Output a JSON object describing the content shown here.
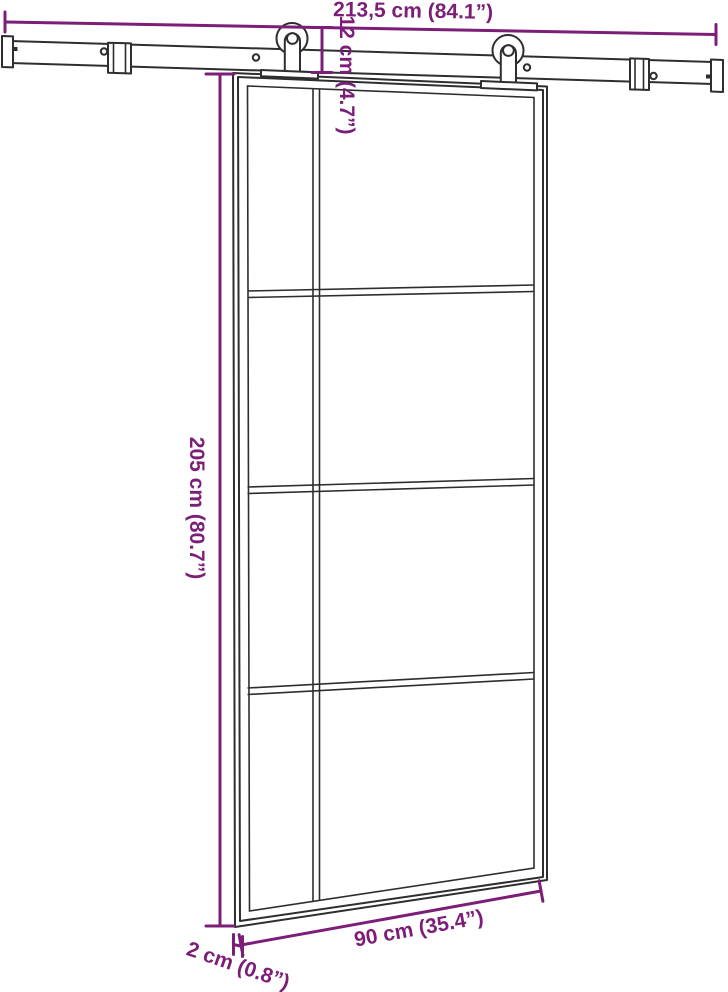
{
  "colors": {
    "dimension_annotation": "#7c1e78",
    "line_art": "#2e2e2e",
    "background": "#ffffff"
  },
  "dimensions": {
    "rail_width": {
      "cm": "213,5",
      "inches": "84.1",
      "label": "213,5 cm (84.1”)"
    },
    "hanger_height": {
      "cm": "12",
      "inches": "4.7",
      "label": "12 cm (4.7”)"
    },
    "door_height": {
      "cm": "205",
      "inches": "80.7",
      "label": "205 cm (80.7”)"
    },
    "door_width": {
      "cm": "90",
      "inches": "35.4",
      "label": "90 cm (35.4”)"
    },
    "door_thickness": {
      "cm": "2",
      "inches": "0.8",
      "label": "2 cm (0.8”)"
    }
  }
}
